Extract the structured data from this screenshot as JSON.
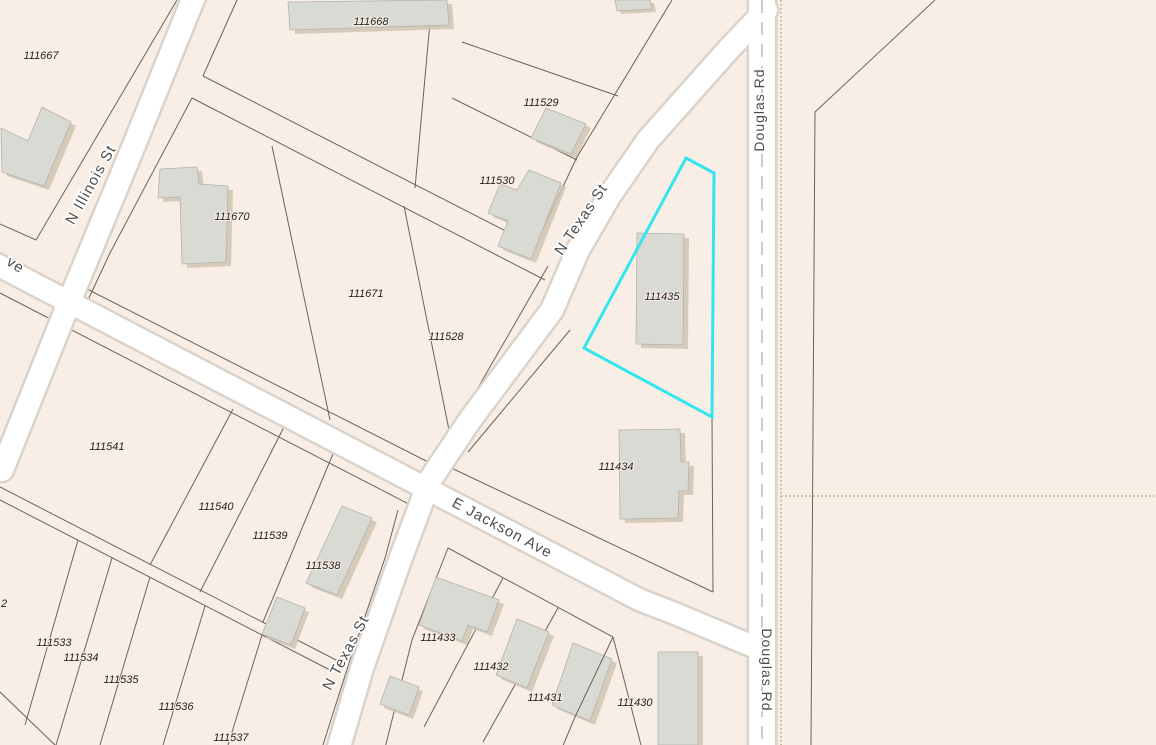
{
  "map": {
    "background_color": "#f9eee6",
    "road_fill_color": "#ffffff",
    "road_casing_color": "#d9d3cc",
    "parcel_line_color": "#6e635c",
    "building_fill_color": "#dadad5",
    "building_shadow_color": "#d0c3b2",
    "highlight_color": "#35e5ee",
    "subdivision_dotted_line_color": "#95a75e",
    "road_centerline_dash_color": "#bcbcbc",
    "highlighted_parcel": "111435",
    "streets": [
      {
        "label": "N Illinois St"
      },
      {
        "label": "N Texas St"
      },
      {
        "label": "N Texas St"
      },
      {
        "label": "E Jackson Ave"
      },
      {
        "label": "ve"
      },
      {
        "label": "Douglas Rd"
      },
      {
        "label": "Douglas Rd"
      }
    ],
    "parcels": [
      {
        "id": "111667"
      },
      {
        "id": "111668"
      },
      {
        "id": "111529"
      },
      {
        "id": "111530"
      },
      {
        "id": "111670"
      },
      {
        "id": "111671"
      },
      {
        "id": "111528"
      },
      {
        "id": "111541"
      },
      {
        "id": "111540"
      },
      {
        "id": "111539"
      },
      {
        "id": "111538"
      },
      {
        "id": "111533"
      },
      {
        "id": "111534"
      },
      {
        "id": "111535"
      },
      {
        "id": "111536"
      },
      {
        "id": "111537"
      },
      {
        "id": "111433"
      },
      {
        "id": "111432"
      },
      {
        "id": "111431"
      },
      {
        "id": "111430"
      },
      {
        "id": "111434"
      },
      {
        "id": "111435"
      },
      {
        "id": "2"
      }
    ]
  }
}
